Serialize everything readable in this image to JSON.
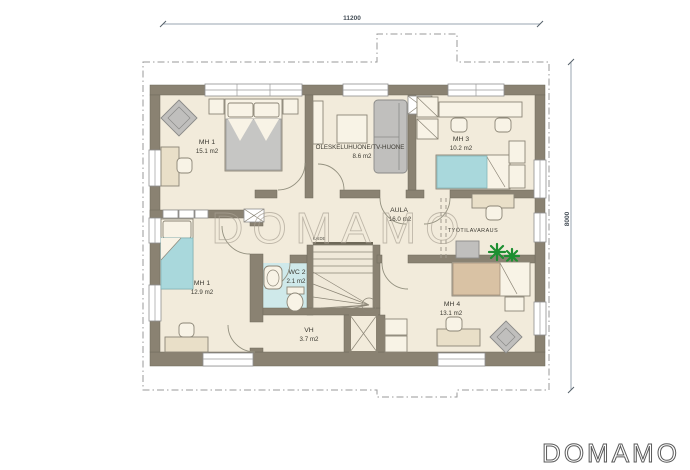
{
  "dimensions": {
    "top": "11200",
    "right": "8000"
  },
  "rooms": [
    {
      "name": "MH 1",
      "area": "15.1 m2"
    },
    {
      "name": "OLESKELUHUONE/TV-HUONE",
      "area": "8.6 m2"
    },
    {
      "name": "MH 3",
      "area": "10.2 m2"
    },
    {
      "name": "AULA",
      "area": "16.0 m2"
    },
    {
      "name": "TYÖTILAVARAUS",
      "area": ""
    },
    {
      "name": "MH 1",
      "area": "12.9 m2"
    },
    {
      "name": "WC 2",
      "area": "2.1 m2"
    },
    {
      "name": "VH",
      "area": "3.7 m2"
    },
    {
      "name": "MH 4",
      "area": "13.1 m2"
    }
  ],
  "labels": {
    "stair_railing": "KAIDE"
  },
  "watermark": {
    "center": "DOMAMO",
    "logo": "DOMAMO"
  },
  "colors": {
    "floor": "#f2ebdb",
    "wall": "#8a8272",
    "wet_floor": "#cfe9ea",
    "bed_teal": "#a9d8dc",
    "bed_tan": "#d9c2a4",
    "sofa_gray": "#c0bfbd",
    "plant_green": "#1d8f31",
    "dimension": "#9aa6b1"
  }
}
